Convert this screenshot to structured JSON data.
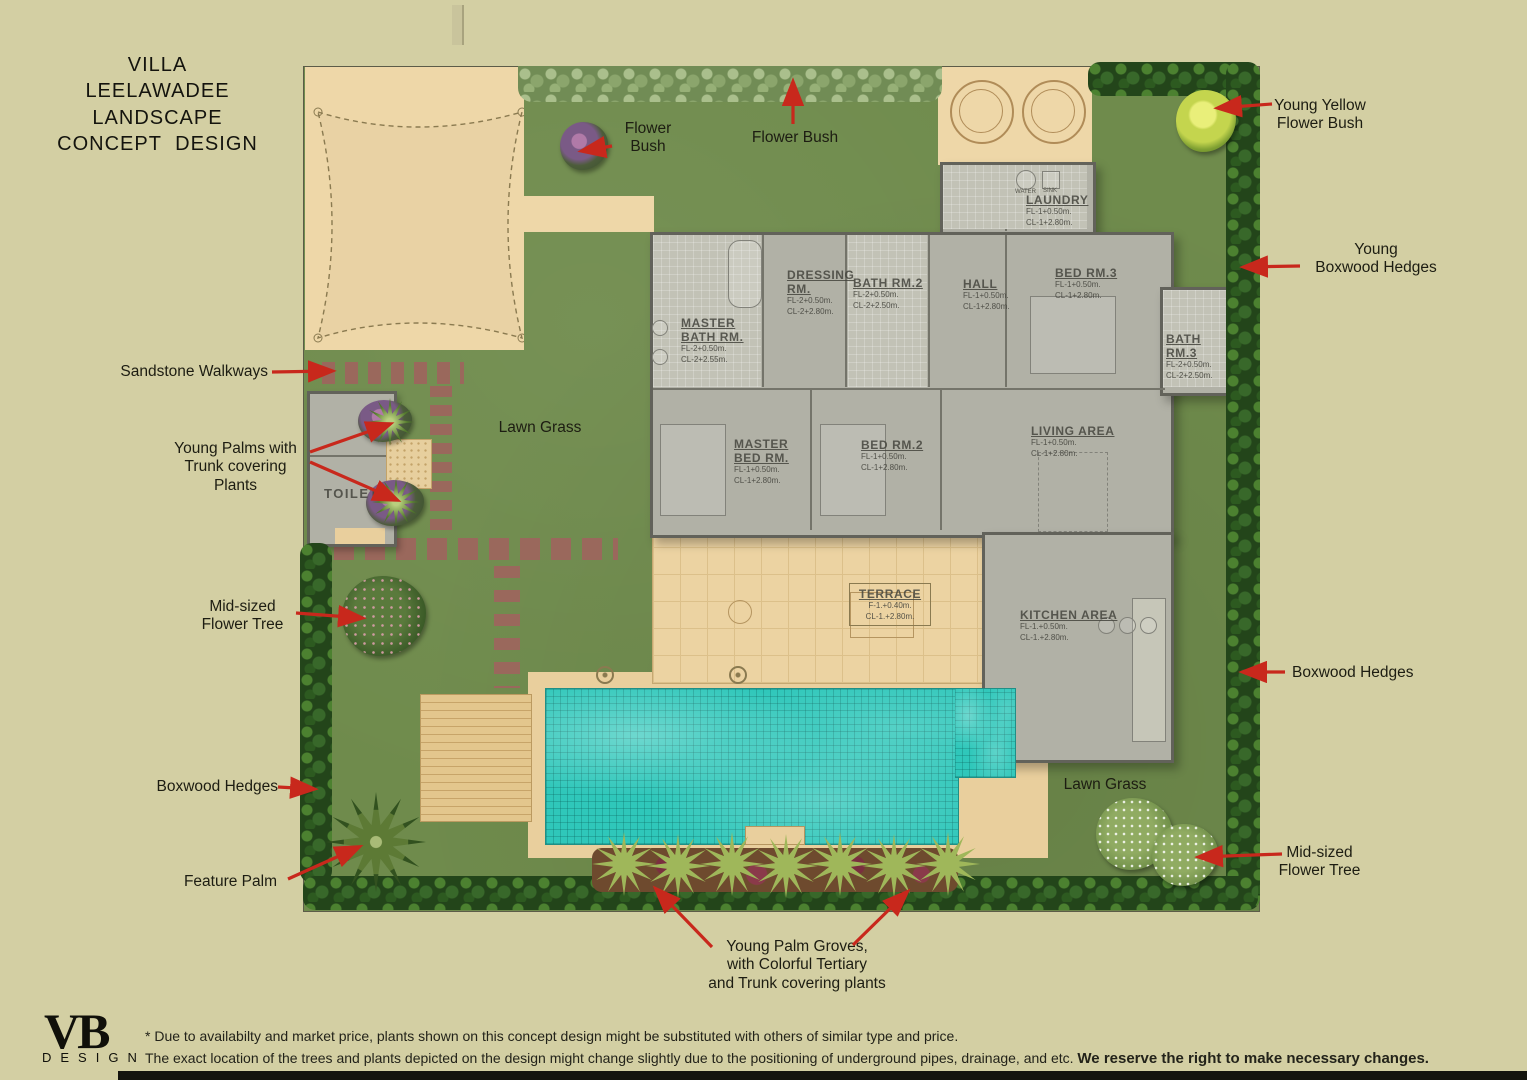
{
  "title": {
    "line1": "VILLA  LEELAWADEE",
    "line2": "LANDSCAPE",
    "line3": "CONCEPT  DESIGN"
  },
  "annotations": {
    "flower_bush_left": {
      "line1": "Flower",
      "line2": "Bush"
    },
    "flower_bush_top": {
      "line1": "Flower Bush"
    },
    "young_yellow_flower_bush": {
      "line1": "Young Yellow",
      "line2": "Flower Bush"
    },
    "young_boxwood_hedges": {
      "line1": "Young",
      "line2": "Boxwood Hedges"
    },
    "sandstone_walkways": {
      "line1": "Sandstone Walkways"
    },
    "young_palms": {
      "line1": "Young Palms with",
      "line2": "Trunk covering",
      "line3": "Plants"
    },
    "lawn_grass_left": {
      "line1": "Lawn Grass"
    },
    "mid_flower_tree_left": {
      "line1": "Mid-sized",
      "line2": "Flower Tree"
    },
    "boxwood_hedges_right": {
      "line1": "Boxwood Hedges"
    },
    "boxwood_hedges_left": {
      "line1": "Boxwood Hedges"
    },
    "feature_palm": {
      "line1": "Feature Palm"
    },
    "lawn_grass_right": {
      "line1": "Lawn Grass"
    },
    "mid_flower_tree_right": {
      "line1": "Mid-sized",
      "line2": "Flower Tree"
    },
    "young_palm_groves": {
      "line1": "Young Palm Groves,",
      "line2": "with Colorful Tertiary",
      "line3": "and Trunk covering plants"
    }
  },
  "rooms": {
    "master_bath": {
      "n1": "MASTER",
      "n2": "BATH RM.",
      "fl": "FL-2+0.50m.",
      "cl": "CL-2+2.55m."
    },
    "dressing": {
      "n1": "DRESSING",
      "n2": "RM.",
      "fl": "FL-2+0.50m.",
      "cl": "CL-2+2.80m."
    },
    "bath2": {
      "n1": "BATH RM.2",
      "fl": "FL-2+0.50m.",
      "cl": "CL-2+2.50m."
    },
    "hall": {
      "n1": "HALL",
      "fl": "FL-1+0.50m.",
      "cl": "CL-1+2.80m."
    },
    "laundry": {
      "n1": "LAUNDRY",
      "fl": "FL-1+0.50m.",
      "cl": "CL-1+2.80m.",
      "water": "WATER",
      "sink": "SINK"
    },
    "bed3": {
      "n1": "BED RM.3",
      "fl": "FL-1+0.50m.",
      "cl": "CL-1+2.80m."
    },
    "bath3": {
      "n1": "BATH",
      "n2": "RM.3",
      "fl": "FL-2+0.50m.",
      "cl": "CL-2+2.50m."
    },
    "master_bed": {
      "n1": "MASTER",
      "n2": "BED RM.",
      "fl": "FL-1+0.50m.",
      "cl": "CL-1+2.80m."
    },
    "bed2": {
      "n1": "BED RM.2",
      "fl": "FL-1+0.50m.",
      "cl": "CL-1+2.80m."
    },
    "living": {
      "n1": "LIVING AREA",
      "fl": "FL-1+0.50m.",
      "cl": "CL-1+2.80m."
    },
    "terrace": {
      "n1": "TERRACE",
      "fl": "F-1.+0.40m.",
      "cl": "CL-1.+2.80m."
    },
    "kitchen": {
      "n1": "KITCHEN AREA",
      "fl": "FL-1.+0.50m.",
      "cl": "CL-1.+2.80m."
    },
    "toilet": {
      "n1": "TOILET"
    }
  },
  "logo": {
    "brand": "VB",
    "sub": "DESIGN"
  },
  "disclaimer": {
    "line1": "* Due to availabilty and market price, plants shown on this concept design might be substituted with others of similar type and price.",
    "line2": "The exact location of the trees and plants depicted on the design might change slightly due to the positioning of underground pipes, drainage, and etc.",
    "emphasis": "We reserve the right to make necessary changes."
  },
  "colors": {
    "background": "#d3cfa3",
    "lawn": "#6f8b4c",
    "hedge": "#2f5a20",
    "sand": "#eed7a8",
    "pool_water": "#2fc7ba",
    "arrow_red": "#c8281c",
    "text": "#1c1c14",
    "paver": "#9a685c"
  }
}
